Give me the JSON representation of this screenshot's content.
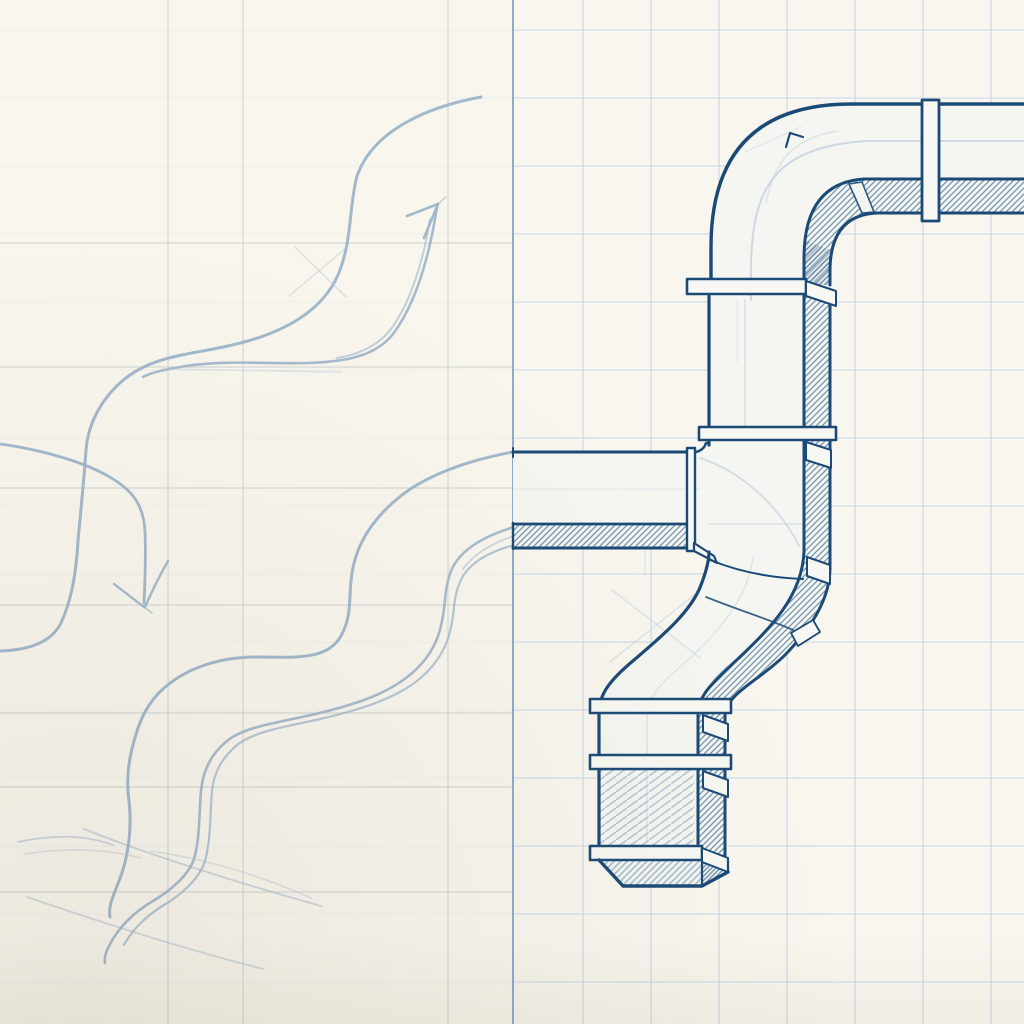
{
  "canvas": {
    "width": 1024,
    "height": 1024,
    "background": "#f8f6ee"
  },
  "subject": "hand-drawn duct pipe sketch: pencil draft with flow arrows on left, inked isometric duct on graph paper on right",
  "colors": {
    "paper": "#f8f6ee",
    "face": "#f5f6f1",
    "flange": "#f7f8f3",
    "ink": "#1b4a77",
    "guide": "#c2d1e0",
    "pencil": "#9db4c9",
    "grid_fine": "#c4d4e3",
    "grid_left": "#cdd3d0",
    "margin_line": "#8ba7c6",
    "vignette": "rgba(118,108,86,0.10)"
  },
  "grid": {
    "margin_line_x": 513,
    "fine_vertical_xs": [
      583,
      651,
      719,
      787,
      855,
      923,
      991
    ],
    "fine_horizontal_ys": [
      30,
      98,
      166,
      234,
      302,
      370,
      438,
      506,
      574,
      642,
      710,
      778,
      846,
      914,
      982
    ],
    "fine_width": 1.1,
    "fine_opacity": 0.9,
    "left_fade_opacity": 0.78,
    "left_vertical_xs": [
      168,
      243,
      448
    ],
    "left_horizontal_ys": [
      243,
      367,
      488,
      605,
      713,
      787,
      892
    ],
    "left_width": 1.2,
    "left_opacity": 0.8,
    "margin_width": 2
  },
  "patterns": [
    {
      "id": "inkHatch",
      "w": 6,
      "h": 6,
      "stroke": "#6a8cab",
      "width": 1.25,
      "paths": [
        "M0,6 L6,0",
        "M-1.5,1.5 L1.5,-1.5",
        "M4.5,7.5 L7.5,4.5"
      ]
    },
    {
      "id": "inkHatchDense",
      "w": 4.4,
      "h": 4.4,
      "stroke": "#5d80a4",
      "width": 1.3,
      "paths": [
        "M0,4.4 L4.4,0",
        "M-1.1,1.1 L1.1,-1.1",
        "M3.3,5.5 L5.5,3.3"
      ]
    },
    {
      "id": "pencilHatch",
      "w": 6.5,
      "h": 6.5,
      "stroke": "#a4bad0",
      "width": 1.6,
      "paths": [
        "M0,6.5 L6.5,0",
        "M-1.6,1.6 L1.6,-1.6",
        "M4.9,8.1 L8.1,4.9"
      ]
    },
    {
      "id": "pencilHatchSparse",
      "w": 11,
      "h": 8,
      "stroke": "#b6c7d8",
      "width": 1.7,
      "paths": [
        "M-1,8.7 L12,-0.7"
      ]
    }
  ],
  "layers": [
    {
      "name": "pencil-sketch",
      "paths": [
        {
          "name": "flow-arrow-up-curve",
          "d": "M481,97 C432,106 374,128 357,176 C349,207 352,238 340,270 C323,316 274,336 228,346 C188,355 150,356 121,382 C101,400 88,424 86,450 C84,480 81,508 78,541 C76,576 71,601 61,623 C51,643 28,650 1,651",
          "stroke": "#9db4c9",
          "width": 3,
          "opacity": 0.95
        },
        {
          "name": "flow-arrow-up-shaft",
          "d": "M437,207 C430,252 417,302 393,334 C375,357 343,362 307,363 C271,364 224,360 186,366 C168,369 152,372 143,377",
          "stroke": "#9db4c9",
          "width": 2.6,
          "opacity": 0.9
        },
        {
          "name": "flow-arrow-up-shaft-2",
          "d": "M430,219 C424,258 411,302 391,329 C378,346 357,355 337,358",
          "stroke": "#9db4c9",
          "width": 2,
          "opacity": 0.6
        },
        {
          "name": "flow-arrow-up-head-barb-1",
          "d": "M438,204 L407,216",
          "stroke": "#9db4c9",
          "width": 2.6,
          "opacity": 0.95
        },
        {
          "name": "flow-arrow-up-head-barb-2",
          "d": "M438,204 L424,238",
          "stroke": "#9db4c9",
          "width": 2.6,
          "opacity": 0.95
        },
        {
          "name": "flow-arrow-up-head-flick",
          "d": "M438,204 L446,197",
          "stroke": "#9db4c9",
          "width": 1.8,
          "opacity": 0.55
        },
        {
          "name": "slip-stroke-1",
          "d": "M295,247 L346,297",
          "stroke": "#b5c6d6",
          "width": 1.6,
          "opacity": 0.45
        },
        {
          "name": "slip-stroke-2",
          "d": "M289,296 C309,279 331,261 348,246",
          "stroke": "#b5c6d6",
          "width": 1.6,
          "opacity": 0.4
        },
        {
          "name": "guide-stroke-h",
          "d": "M162,369 L341,372",
          "stroke": "#b5c6d6",
          "width": 1.4,
          "opacity": 0.4
        },
        {
          "name": "flow-arrow-down-shaft",
          "d": "M1,444 C42,450 86,462 113,479 C134,492 144,507 145,532 C146,558 145,582 144,603",
          "stroke": "#9db4c9",
          "width": 2.8,
          "opacity": 0.95
        },
        {
          "name": "flow-arrow-down-barb-1",
          "d": "M144,607 L114,584",
          "stroke": "#9db4c9",
          "width": 2.4,
          "opacity": 0.9
        },
        {
          "name": "flow-arrow-down-barb-2",
          "d": "M168,561 C160,575 152,591 145,607",
          "stroke": "#9db4c9",
          "width": 2.4,
          "opacity": 0.9
        },
        {
          "name": "flow-arrow-down-flick",
          "d": "M144,607 L152,613",
          "stroke": "#9db4c9",
          "width": 1.8,
          "opacity": 0.6
        },
        {
          "name": "draft-duct-top-edge",
          "d": "M513,452 C468,460 424,476 397,499 C371,521 356,546 352,573 C348,597 353,614 341,636 C327,661 293,657 257,657 C219,657 187,668 164,688 C148,702 140,719 134,741 C128,762 126,781 129,801 C132,826 129,856 119,881 C113,897 108,906 110,917",
          "stroke": "#9db4c9",
          "width": 3,
          "opacity": 0.95
        },
        {
          "name": "draft-duct-band-stroke-1",
          "d": "M514,527 C481,537 459,551 451,571 C444,589 446,603 442,621 C438,644 426,663 406,678 C381,697 346,707 311,715 C276,723 244,727 227,741 C212,753 203,769 201,791 C199,813 200,839 194,859 C189,874 173,889 153,901 C136,911 119,926 109,946 C105,954 104,959 105,963",
          "stroke": "#9db4c9",
          "width": 2.6,
          "opacity": 0.9
        },
        {
          "name": "draft-duct-band-stroke-2",
          "d": "M514,545 C485,553 467,565 460,582 C453,598 455,609 451,627 C447,649 434,669 413,684 C387,702 351,712 316,720 C283,727 253,732 237,745 C223,757 214,771 212,791 C210,813 211,839 205,861 C200,877 184,893 164,905 C149,914 133,928 124,945",
          "stroke": "#9db4c9",
          "width": 2.2,
          "opacity": 0.75
        },
        {
          "name": "draft-duct-band-stroke-3",
          "d": "M514,536 C492,543 474,554 463,569",
          "stroke": "#9db4c9",
          "width": 1.8,
          "opacity": 0.5
        },
        {
          "name": "loose-stroke-1",
          "d": "M18,842 C55,834 86,835 113,845",
          "stroke": "#9db4c9",
          "width": 1.8,
          "opacity": 0.5
        },
        {
          "name": "loose-stroke-2",
          "d": "M24,854 C70,847 106,849 141,858",
          "stroke": "#b5c6d6",
          "width": 1.6,
          "opacity": 0.45
        },
        {
          "name": "loose-stroke-3",
          "d": "M84,829 C152,856 232,881 321,906",
          "stroke": "#9db4c9",
          "width": 1.8,
          "opacity": 0.5
        },
        {
          "name": "loose-stroke-4",
          "d": "M27,897 C100,922 181,948 263,969",
          "stroke": "#9db4c9",
          "width": 1.8,
          "opacity": 0.45
        },
        {
          "name": "loose-stroke-5",
          "d": "M151,851 C212,860 264,877 311,898",
          "stroke": "#b5c6d6",
          "width": 1.6,
          "opacity": 0.45
        }
      ]
    },
    {
      "name": "duct-faces",
      "paths": [
        {
          "name": "face-top-run-and-elbow",
          "d": "M711,285 L711,247 Q711,104 852,104 L1024,104 L1024,214 L875,214 Q829,216 829,272 L829,285 Z",
          "fill": "#f5f6f1"
        },
        {
          "name": "face-flange-elbow-zone",
          "d": "M687,279 L836,279 L836,294 L687,294 Z",
          "fill": "#f5f6f1"
        },
        {
          "name": "face-vertical-s-lower",
          "d": "M707,294 L829,294 L829,568 C829,600 809,629 784,655 C758,681 724,694 724,716 L724,872 L598,872 L598,712 C598,694 609,680 634,658 C662,634 694,609 703,582 C708,568 707,560 707,552 L707,294 Z",
          "fill": "#f5f6f1"
        },
        {
          "name": "face-bottom-collar",
          "d": "M590,846 L728,846 L728,873 L702,886 L622,886 L598,861 L590,861 Z",
          "fill": "#f5f6f1"
        },
        {
          "name": "face-branch",
          "d": "M513,452 L707,452 L707,548 L513,548 Z",
          "fill": "#f5f6f1"
        }
      ]
    },
    {
      "name": "duct-hatch",
      "paths": [
        {
          "name": "hatch-top-run-underside",
          "d": "M840,180 L1024,180 L1024,213 L877,213 Q830,215 830,270 L830,285 L804,285 L804,258 Q804,184 862,181 Z",
          "fill": "url(#inkHatch)",
          "opacity": 0.95
        },
        {
          "name": "hatch-elbow-corner-dense",
          "d": "M804,240 L830,250 L830,285 L804,285 Z",
          "fill": "url(#inkHatchDense)",
          "opacity": 0.6
        },
        {
          "name": "hatch-side-band",
          "d": "M804,294 L829,294 L829,568 C829,600 809,629 784,655 C758,681 724,694 724,716 L724,858 L698,858 L698,714 C698,692 712,679 740,654 C767,629 802,599 804,562 Z",
          "fill": "url(#inkHatch)",
          "opacity": 0.95
        },
        {
          "name": "hatch-branch-underside",
          "d": "M513,525 L687,525 L687,548 L513,548 Z",
          "fill": "url(#inkHatch)",
          "opacity": 0.95
        },
        {
          "name": "hatch-lower-front-section",
          "d": "M599,770 L694,770 L694,845 L599,845 Z",
          "fill": "url(#pencilHatchSparse)",
          "opacity": 0.95
        },
        {
          "name": "hatch-collar-front",
          "d": "M598,861 L622,886 L702,886 L702,861 Z",
          "fill": "url(#pencilHatch)",
          "opacity": 0.95
        },
        {
          "name": "hatch-collar-side",
          "d": "M702,861 L728,873 L702,886 Z",
          "fill": "url(#inkHatchDense)",
          "opacity": 0.9
        }
      ]
    },
    {
      "name": "duct-guides",
      "paths": [
        {
          "name": "guide-elbow-centerline",
          "d": "M1024,141 L866,141 C790,146 760,175 753,235 C750,262 751,270 751,300",
          "stroke": "#c2d1e0",
          "width": 2,
          "opacity": 0.8
        },
        {
          "name": "guide-elbow-inner-arc",
          "d": "M838,131 C792,138 774,162 766,203",
          "stroke": "#c2d1e0",
          "width": 1.5,
          "opacity": 0.5
        },
        {
          "name": "guide-elbow-slash",
          "d": "M745,152 L801,127",
          "stroke": "#c2d1e0",
          "width": 1.5,
          "opacity": 0.35
        },
        {
          "name": "guide-vertical-center-1",
          "d": "M745,300 L745,425",
          "stroke": "#c2d1e0",
          "width": 1.6,
          "opacity": 0.55
        },
        {
          "name": "guide-vertical-center-2",
          "d": "M737,300 L737,362",
          "stroke": "#c2d1e0",
          "width": 1.2,
          "opacity": 0.35
        },
        {
          "name": "guide-junction-sweep",
          "d": "M700,458 C741,471 780,507 799,546",
          "stroke": "#c2d1e0",
          "width": 1.8,
          "opacity": 0.7
        },
        {
          "name": "guide-junction-horizontal",
          "d": "M709,524 L802,524",
          "stroke": "#c2d1e0",
          "width": 1.5,
          "opacity": 0.55
        },
        {
          "name": "guide-branch-ghost",
          "d": "M513,489 L700,489",
          "stroke": "#c2d1e0",
          "width": 1.2,
          "opacity": 0.3
        },
        {
          "name": "guide-s-cross-1",
          "d": "M612,590 L700,658",
          "stroke": "#c2d1e0",
          "width": 1.5,
          "opacity": 0.5
        },
        {
          "name": "guide-s-cross-2",
          "d": "M698,592 L610,662",
          "stroke": "#c2d1e0",
          "width": 1.5,
          "opacity": 0.5
        },
        {
          "name": "guide-s-entry",
          "d": "M645,545 L645,576",
          "stroke": "#c2d1e0",
          "width": 1.4,
          "opacity": 0.45
        },
        {
          "name": "guide-s-centerline",
          "d": "M753,557 C749,595 720,631 690,658 C666,679 650,693 648,710",
          "stroke": "#c2d1e0",
          "width": 1.5,
          "opacity": 0.45
        },
        {
          "name": "guide-lower-centerline",
          "d": "M647,714 L647,843",
          "stroke": "#c2d1e0",
          "width": 1.5,
          "opacity": 0.5
        }
      ]
    },
    {
      "name": "duct-ink",
      "paths": [
        {
          "name": "ink-elbow-outer",
          "d": "M711,282 L711,247 Q711,104 852,104 L1024,104",
          "stroke": "#1b4a77",
          "width": 3.4
        },
        {
          "name": "ink-top-run-front-bottom",
          "d": "M1024,179 L864,179 Q804,183 804,258 L804,285",
          "stroke": "#1b4a77",
          "width": 3
        },
        {
          "name": "ink-top-run-band-bottom",
          "d": "M1024,213 L877,213 Q830,215 830,271 L830,285",
          "stroke": "#1b4a77",
          "width": 3
        },
        {
          "name": "ink-elbow-nub",
          "d": "M786,147 L790,133 L803,137",
          "stroke": "#1b4a77",
          "width": 2.2
        },
        {
          "name": "ink-corner-seam-gap",
          "d": "M849,184 L862,182 L874,212 L862,213 Z",
          "fill": "#f7f8f3",
          "stroke": "#1b4a77",
          "width": 1.6,
          "opacity": 0.9
        },
        {
          "name": "ink-left-edge-upper",
          "d": "M709,294 L709,445",
          "stroke": "#1b4a77",
          "width": 3.2
        },
        {
          "name": "ink-right-front-edge",
          "d": "M804,294 L804,552",
          "stroke": "#1b4a77",
          "width": 3
        },
        {
          "name": "ink-band-outer-edge",
          "d": "M830,294 L830,568 C830,600 810,629 785,655 C759,681 725,694 725,716 L725,858",
          "stroke": "#1b4a77",
          "width": 3
        },
        {
          "name": "ink-branch-top-edge",
          "d": "M513,452 L687,452",
          "stroke": "#1b4a77",
          "width": 3
        },
        {
          "name": "ink-branch-nub",
          "d": "M687,452 L696,452 Q704,450 706,443 L709,443",
          "stroke": "#1b4a77",
          "width": 2.4
        },
        {
          "name": "ink-branch-face-bottom",
          "d": "M513,524 L687,524",
          "stroke": "#1b4a77",
          "width": 2.8
        },
        {
          "name": "ink-branch-band-bottom",
          "d": "M513,548 L687,548",
          "stroke": "#1b4a77",
          "width": 3
        },
        {
          "name": "ink-branch-end-cap",
          "d": "M513,523 L513,549",
          "stroke": "#1b4a77",
          "width": 2.4
        },
        {
          "name": "ink-branch-end-tick",
          "d": "M513,448 L513,457",
          "stroke": "#1b4a77",
          "width": 2
        },
        {
          "name": "ink-branch-collar",
          "d": "M687,448 L695,448 L695,551 L687,551 Z",
          "fill": "#f7f8f3",
          "stroke": "#1b4a77",
          "width": 2.4
        },
        {
          "name": "ink-branch-chamfer",
          "d": "M694,543 L714,556 L717,563 L694,551 Z",
          "fill": "#f7f8f3",
          "stroke": "#1b4a77",
          "width": 2.2
        },
        {
          "name": "ink-s-outer-edge",
          "d": "M709,552 C709,561 706,572 701,585 C691,612 661,637 634,660 C610,680 599,694 599,713 L599,860",
          "stroke": "#1b4a77",
          "width": 3.2
        },
        {
          "name": "ink-s-inner-edge",
          "d": "M804,552 C802,597 769,629 741,656 C714,681 698,695 698,714 L698,858",
          "stroke": "#1b4a77",
          "width": 3
        },
        {
          "name": "ink-s-seam-top",
          "d": "M710,560 C740,572 773,578 803,579",
          "stroke": "#1b4a77",
          "width": 2
        },
        {
          "name": "ink-s-seam-mid",
          "d": "M706,597 C741,611 771,620 793,630",
          "stroke": "#1b4a77",
          "width": 1.8,
          "opacity": 0.85
        },
        {
          "name": "ink-s-band-gap-mid",
          "d": "M791,633 L813,620 L820,632 L798,646 Z",
          "fill": "#f7f8f3",
          "stroke": "#1b4a77",
          "width": 1.8
        },
        {
          "name": "flange-top-run",
          "d": "M922,100 L939,100 L939,221 L922,221 Z",
          "fill": "#f7f8f3",
          "stroke": "#1b4a77",
          "width": 2.8
        },
        {
          "name": "flange-below-elbow",
          "d": "M687,279 L806,279 L806,294 L687,294 Z",
          "fill": "#f7f8f3",
          "stroke": "#1b4a77",
          "width": 2.6
        },
        {
          "name": "flange-below-elbow-side",
          "d": "M806,281 L836,291 L836,306 L806,296 Z",
          "fill": "#f7f8f3",
          "stroke": "#1b4a77",
          "width": 2
        },
        {
          "name": "flange-upper-vertical",
          "d": "M699,427 L836,427 L836,440 L699,440 Z",
          "fill": "#f7f8f3",
          "stroke": "#1b4a77",
          "width": 2.6
        },
        {
          "name": "flange-upper-vertical-side",
          "d": "M806,442 L831,450 L831,468 L806,460 Z",
          "fill": "#f7f8f3",
          "stroke": "#1b4a77",
          "width": 2
        },
        {
          "name": "flange-s-start-side",
          "d": "M807,557 L830,565 L830,584 L807,576 Z",
          "fill": "#f7f8f3",
          "stroke": "#1b4a77",
          "width": 2
        },
        {
          "name": "flange-lower-1",
          "d": "M590,699 L731,699 L731,713 L590,713 Z",
          "fill": "#f7f8f3",
          "stroke": "#1b4a77",
          "width": 2.6
        },
        {
          "name": "flange-lower-1-side",
          "d": "M703,715 L728,724 L728,741 L703,732 Z",
          "fill": "#f7f8f3",
          "stroke": "#1b4a77",
          "width": 2
        },
        {
          "name": "flange-lower-2",
          "d": "M590,755 L731,755 L731,769 L590,769 Z",
          "fill": "#f7f8f3",
          "stroke": "#1b4a77",
          "width": 2.6
        },
        {
          "name": "flange-lower-2-side",
          "d": "M703,771 L728,780 L728,797 L703,788 Z",
          "fill": "#f7f8f3",
          "stroke": "#1b4a77",
          "width": 2
        },
        {
          "name": "flange-lower-3",
          "d": "M590,846 L702,846 L702,860 L590,860 Z",
          "fill": "#f7f8f3",
          "stroke": "#1b4a77",
          "width": 2.6
        },
        {
          "name": "flange-lower-3-side",
          "d": "M702,848 L728,858 L728,872 L702,862 Z",
          "fill": "#f7f8f3",
          "stroke": "#1b4a77",
          "width": 2
        },
        {
          "name": "ink-collar-outline",
          "d": "M599,860 L623,886 L702,886 L728,872",
          "stroke": "#1b4a77",
          "width": 3.4
        },
        {
          "name": "ink-collar-right-edge",
          "d": "M702,861 L702,886",
          "stroke": "#1b4a77",
          "width": 2.2
        },
        {
          "name": "ink-collar-side-edge",
          "d": "M728,860 L728,872",
          "stroke": "#1b4a77",
          "width": 2.2
        }
      ]
    }
  ]
}
